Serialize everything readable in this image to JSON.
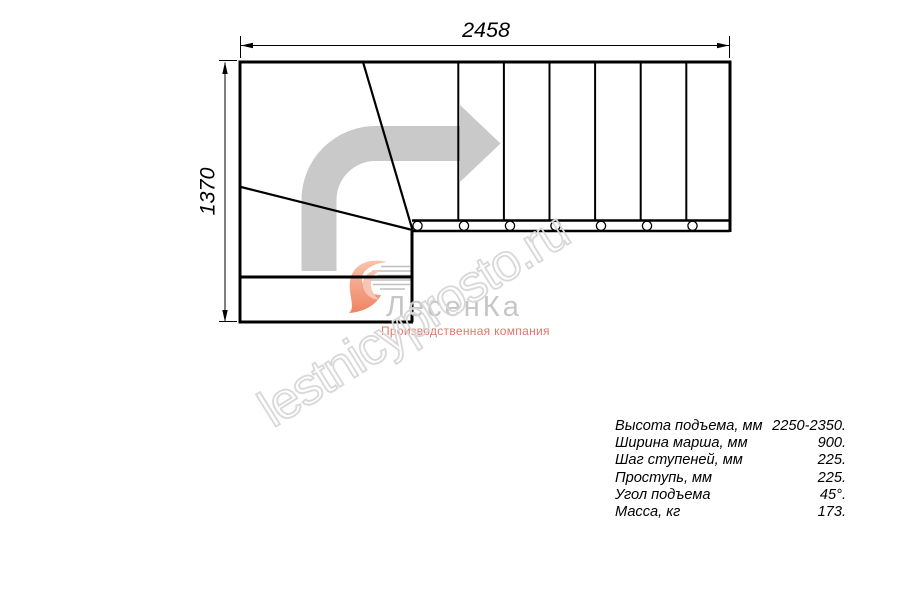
{
  "page": {
    "background": "#ffffff"
  },
  "dimensions": {
    "width_mm": "2458",
    "height_mm": "1370"
  },
  "drawing": {
    "type": "staircase-floor-plan",
    "direction_arrow_icon": "curved-right-arrow",
    "straight_step_lines": 6,
    "winder_lines": 2,
    "baluster_circles": 7,
    "line_color": "#000000",
    "arrow_color": "#c9c9c9"
  },
  "watermark": {
    "text": "lestnicyprosto.ru",
    "color": "#d8d8d8"
  },
  "logo": {
    "mark_icon": "heart-swoosh-icon",
    "name": "ЛесенКа",
    "name_color": "#c6c6c6",
    "subtitle": "Производственная компания",
    "subtitle_color": "#e4756a"
  },
  "specs": {
    "rows": [
      {
        "label": "Высота подъема, мм",
        "value": "2250-2350."
      },
      {
        "label": "Ширина марша, мм",
        "value": "900."
      },
      {
        "label": "Шаг ступеней, мм",
        "value": "225."
      },
      {
        "label": "Проступь, мм",
        "value": "225."
      },
      {
        "label": "Угол подъема",
        "value": "45°."
      },
      {
        "label": "Масса, кг",
        "value": "173."
      }
    ]
  }
}
